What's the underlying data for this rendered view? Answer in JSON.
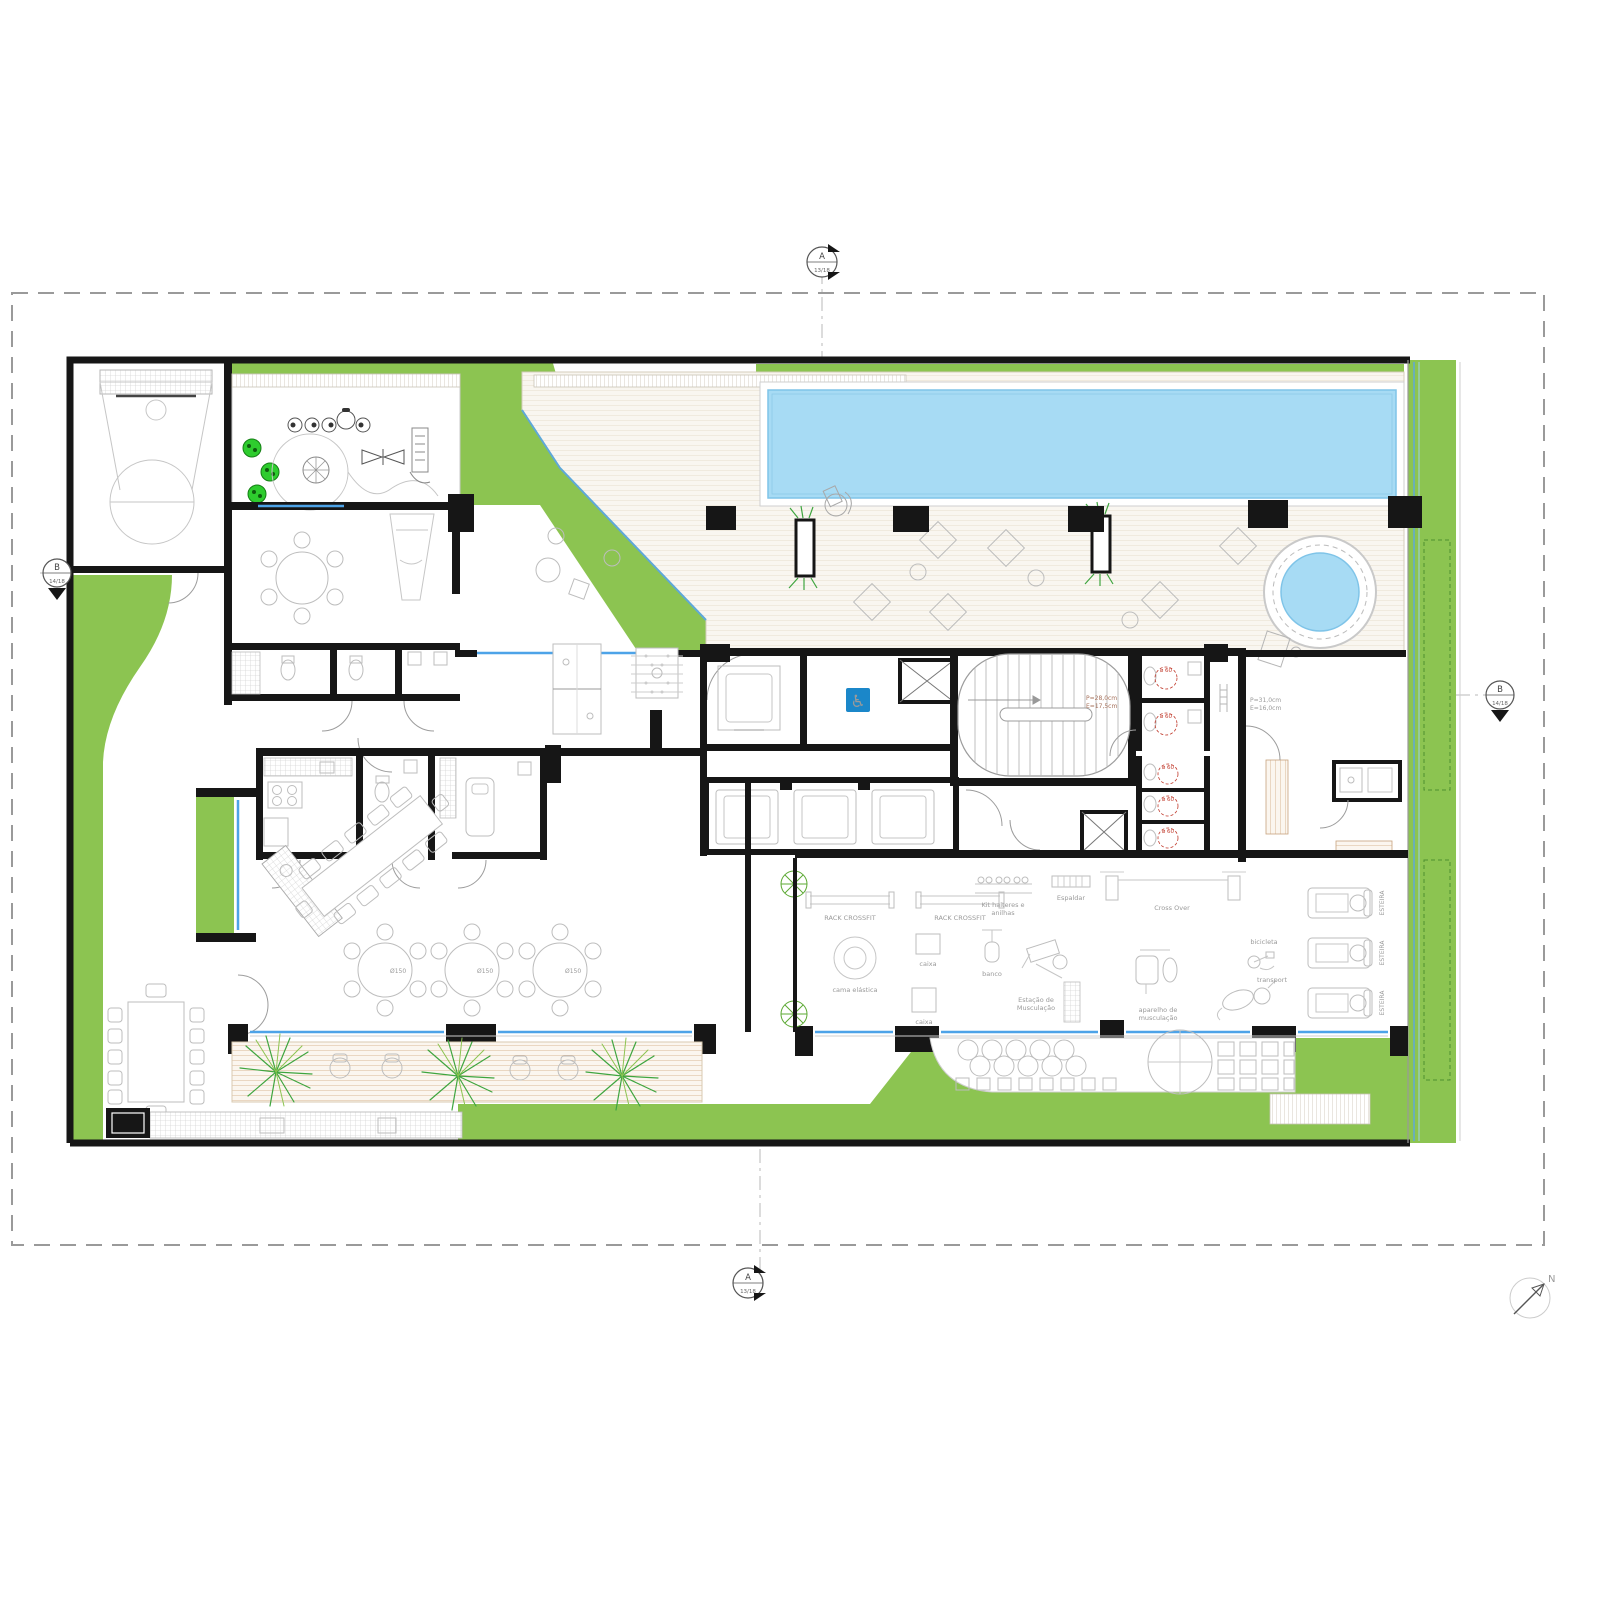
{
  "markers": {
    "a_letter": "A",
    "a_sheet": "13/18",
    "b_letter": "B",
    "b_sheet": "14/18",
    "north": "N"
  },
  "notes": {
    "main_stair_tread": "P=28,0cm",
    "main_stair_riser": "E=17,5cm",
    "deck_stair_tread": "P=31,0cm",
    "deck_stair_riser": "E=16,0cm",
    "turning_circle": "ø 60",
    "round_table_size": "Ø150"
  },
  "gym_labels": {
    "rack": "RACK CROSSFIT",
    "box": "caixa",
    "bench": "banco",
    "dumbbells_line1": "Kit halteres e",
    "dumbbells_line2": "anilhas",
    "wall_bars": "Espaldar",
    "cross_over": "Cross Over",
    "station_line1": "Estação de",
    "station_line2": "Musculação",
    "machine_line1": "aparelho de",
    "machine_line2": "musculação",
    "bike": "bicicleta",
    "elliptical": "transport",
    "treadmill": "ESTEIRA",
    "trampoline": "cama elástica"
  },
  "colors": {
    "lawn": "#8CC451",
    "water": "#A7DBF4",
    "water_edge": "#7FC4E8",
    "wall": "#161616",
    "glazing": "#4DA3E8",
    "deck": "#F9F6F0",
    "accent_red": "#C0392B",
    "accessible_blue": "#1B87C9",
    "spring_toy_green": "#2ECC2E"
  }
}
